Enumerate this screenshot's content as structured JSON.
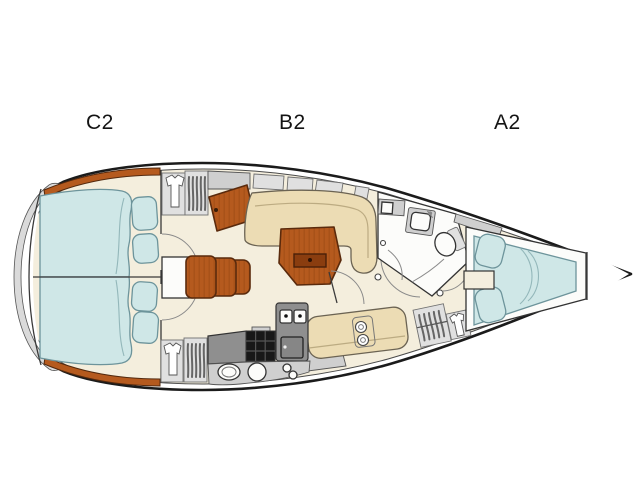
{
  "page": {
    "background": "#ffffff"
  },
  "labels": {
    "c2": "C2",
    "b2": "B2",
    "a2": "A2"
  },
  "colors": {
    "outline": "#1b1b1b",
    "floor": "#f4eedd",
    "wood": "#b55a1e",
    "woodline": "#5a2a0c",
    "cushion": "#cfe7e7",
    "cushionline": "#6d949b",
    "upholstery": "#ecdcb4",
    "upholsteryline": "#6b6353",
    "graydark": "#8f8f8f",
    "graymid": "#cfcfcf",
    "graylight": "#e0e0e0",
    "fixturewhite": "#fcfcfa"
  }
}
